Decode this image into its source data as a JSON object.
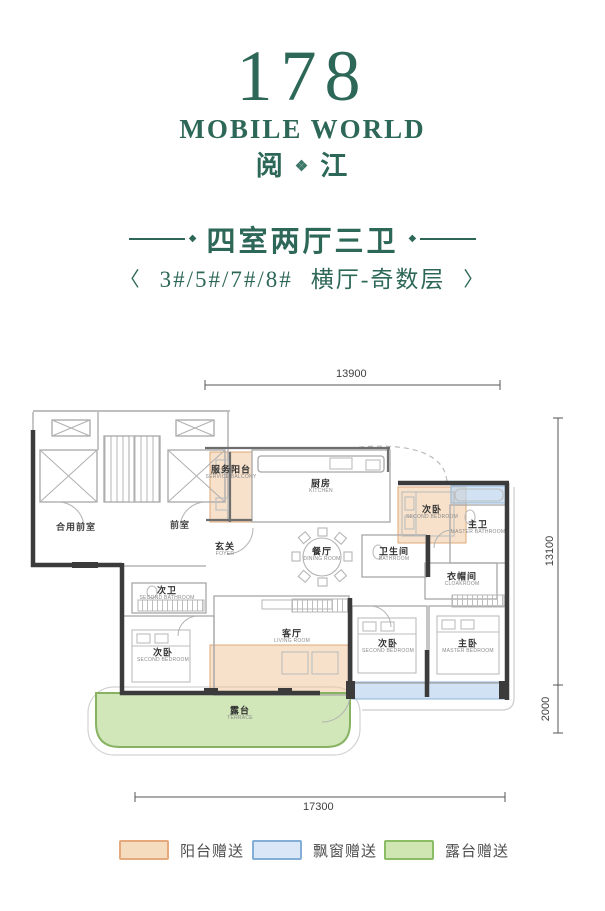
{
  "logo": {
    "number": "178",
    "brand": "MOBILE WORLD",
    "cn_left": "阅",
    "cn_right": "江",
    "ornament": "❖"
  },
  "header": {
    "title": "四室两厅三卫",
    "bracket_left": "〈",
    "buildings": "3#/5#/7#/8#",
    "layout_type": "横厅-奇数层",
    "bracket_right": "〉"
  },
  "plan": {
    "rooms": [
      {
        "name": "合用前室",
        "en": ""
      },
      {
        "name": "前室",
        "en": ""
      },
      {
        "name": "服务阳台",
        "en": "SERVICE BALCONY"
      },
      {
        "name": "厨房",
        "en": "KITCHEN"
      },
      {
        "name": "玄关",
        "en": "FOYER"
      },
      {
        "name": "餐厅",
        "en": "DINING ROOM"
      },
      {
        "name": "卫生间",
        "en": "BATHROOM"
      },
      {
        "name": "次卧",
        "en": "SECOND BEDROOM"
      },
      {
        "name": "主卫",
        "en": "MASTER BATHROOM"
      },
      {
        "name": "衣帽间",
        "en": "CLOAKROOM"
      },
      {
        "name": "次卫",
        "en": "SECOND BATHROOM"
      },
      {
        "name": "次卧",
        "en": "SECOND BEDROOM"
      },
      {
        "name": "客厅",
        "en": "LIVING ROOM"
      },
      {
        "name": "次卧",
        "en": "SECOND BEDROOM"
      },
      {
        "name": "主卧",
        "en": "MASTER BEDROOM"
      },
      {
        "name": "露台",
        "en": "TERRACE"
      }
    ],
    "dimensions": {
      "top": "13900",
      "right_upper": "13100",
      "right_lower": "2000",
      "bottom": "17300"
    }
  },
  "legend": {
    "items": [
      {
        "label": "阳台赠送",
        "fill": "#f6dcbe",
        "border": "#e4aa7e"
      },
      {
        "label": "飘窗赠送",
        "fill": "#d9e7f6",
        "border": "#84aed6"
      },
      {
        "label": "露台赠送",
        "fill": "#cfe6b2",
        "border": "#8bbd66"
      }
    ]
  },
  "colors": {
    "brand_green": "#2d6757",
    "wall": "#3b3b3b",
    "balcony_fill": "#f1c9a0",
    "bay_fill": "#bcd6ee",
    "terrace_fill": "#c9e2ad"
  }
}
